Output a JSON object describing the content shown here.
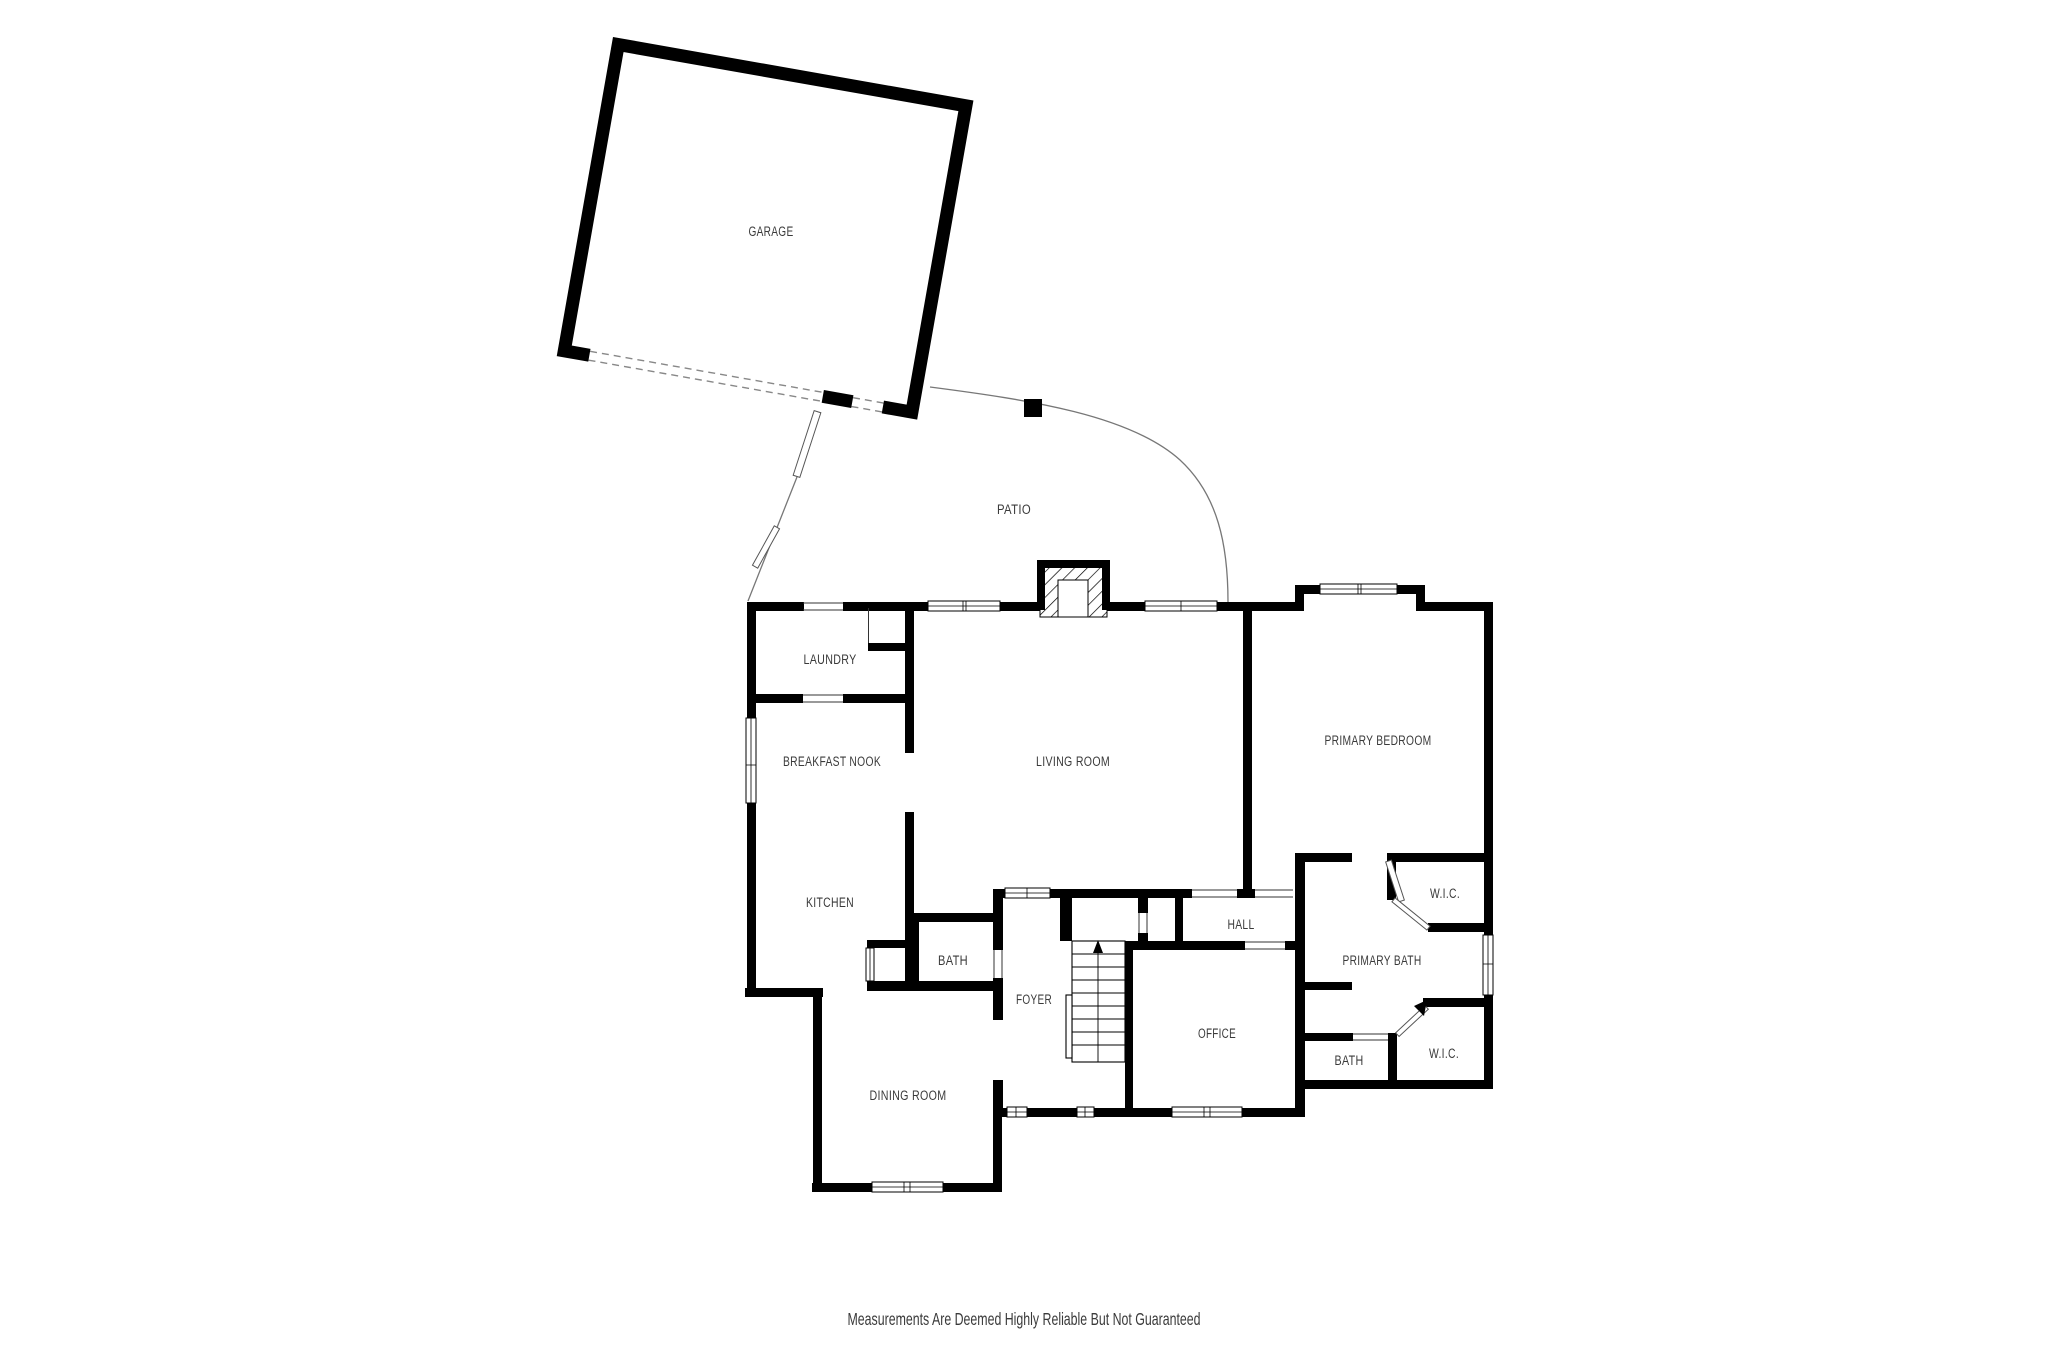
{
  "rooms": {
    "garage": "GARAGE",
    "patio": "PATIO",
    "laundry": "LAUNDRY",
    "breakfast_nook": "BREAKFAST NOOK",
    "living_room": "LIVING ROOM",
    "primary_bedroom": "PRIMARY BEDROOM",
    "kitchen": "KITCHEN",
    "bath": "BATH",
    "foyer": "FOYER",
    "hall": "HALL",
    "office": "OFFICE",
    "primary_bath": "PRIMARY BATH",
    "wic_upper": "W.I.C.",
    "wic_lower": "W.I.C.",
    "bath_lower": "BATH",
    "dining_room": "DINING ROOM"
  },
  "disclaimer": "Measurements Are Deemed Highly Reliable But Not Guaranteed",
  "colors": {
    "wall": "#000000",
    "label": "#3a3a3a",
    "background": "#ffffff"
  }
}
